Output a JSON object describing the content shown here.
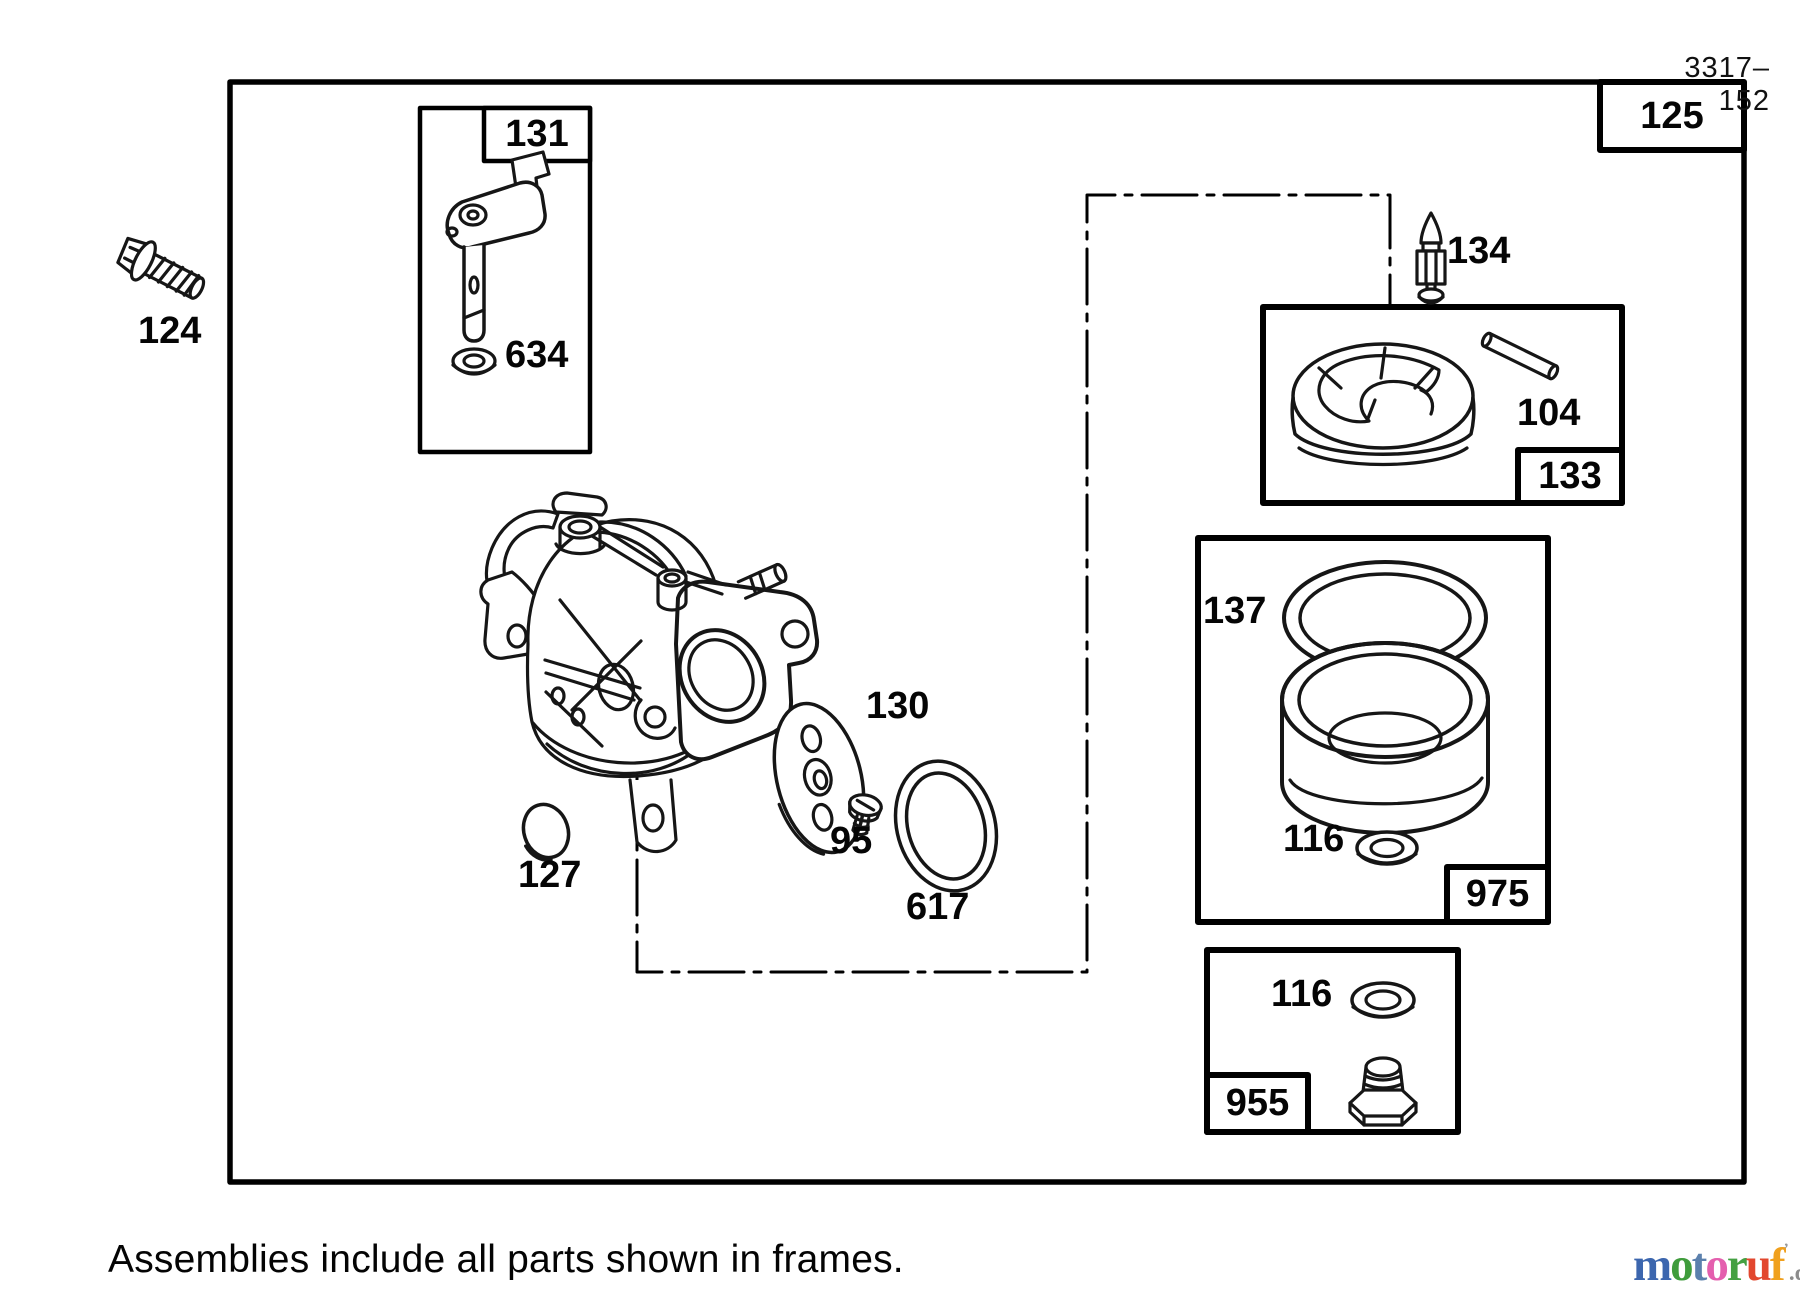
{
  "page": {
    "sheet_number": "3317–152",
    "caption": "Assemblies include all parts shown in frames.",
    "logo": {
      "mark": "’",
      "suffix": ".de",
      "letters": [
        {
          "ch": "m",
          "color": "#3c66ae"
        },
        {
          "ch": "o",
          "color": "#3f9c3c"
        },
        {
          "ch": "t",
          "color": "#5b80ad"
        },
        {
          "ch": "o",
          "color": "#e45fae"
        },
        {
          "ch": "r",
          "color": "#44a042"
        },
        {
          "ch": "u",
          "color": "#e2472e"
        },
        {
          "ch": "f",
          "color": "#f0a01d"
        }
      ]
    }
  },
  "callouts": {
    "c124": "124",
    "c125": "125",
    "c131": "131",
    "c634": "634",
    "c127": "127",
    "c130": "130",
    "c95": "95",
    "c617": "617",
    "c134": "134",
    "c104": "104",
    "c133": "133",
    "c137": "137",
    "c116_bowl": "116",
    "c975": "975",
    "c116_drain": "116",
    "c955": "955"
  }
}
